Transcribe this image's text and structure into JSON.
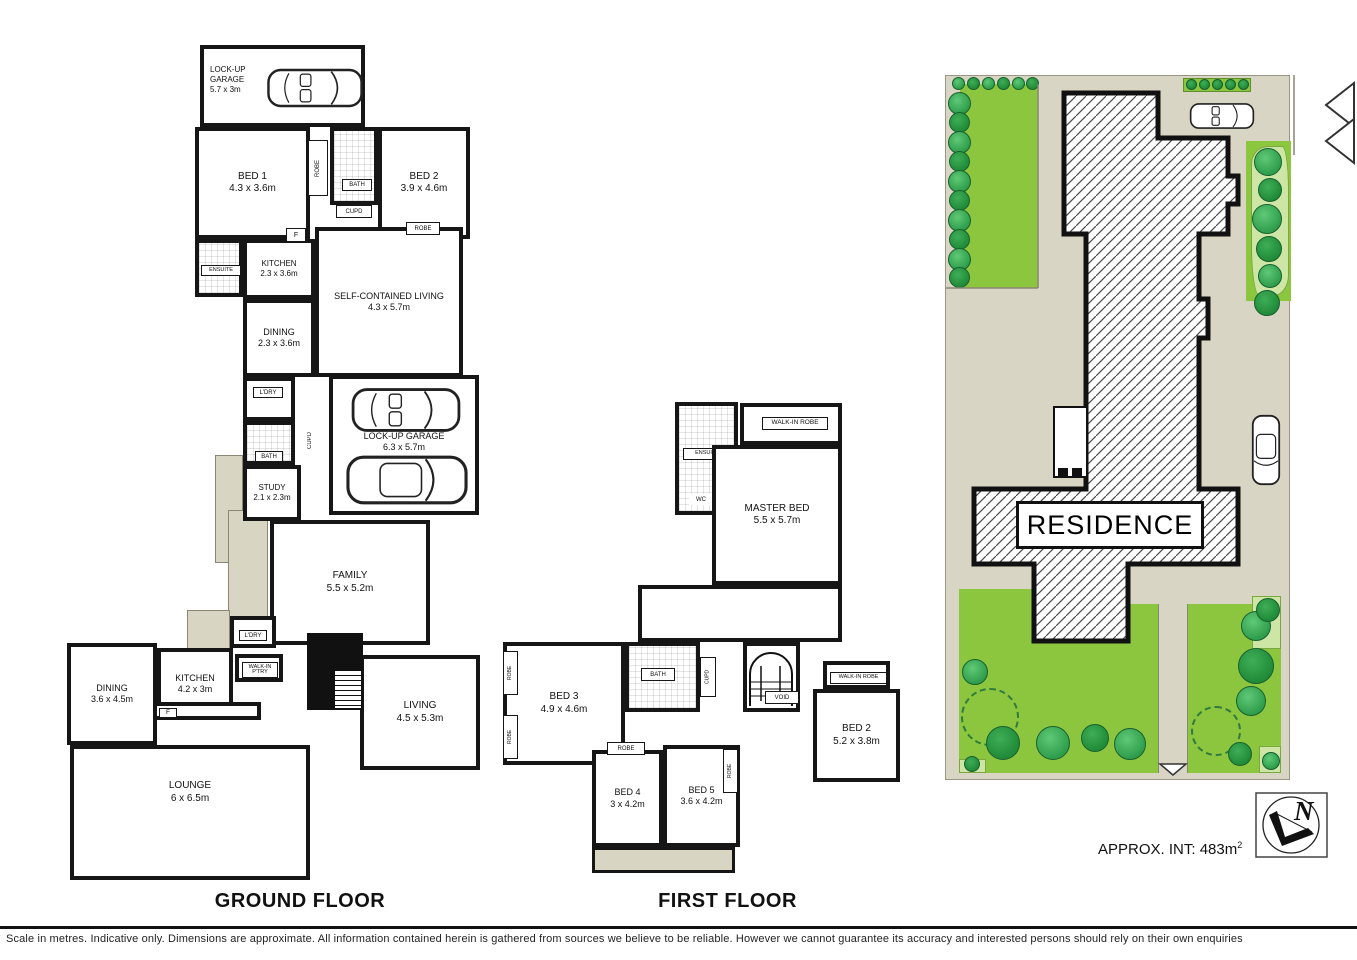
{
  "ground": {
    "title": "GROUND FLOOR",
    "rooms": {
      "garage_top": {
        "name": "LOCK-UP GARAGE",
        "dims": "5.7 x 3m"
      },
      "bed1": {
        "name": "BED 1",
        "dims": "4.3 x 3.6m"
      },
      "bed2": {
        "name": "BED 2",
        "dims": "3.9 x 4.6m"
      },
      "bath_top": {
        "name": "BATH"
      },
      "robe_bed1": {
        "name": "ROBE"
      },
      "robe_bed2": {
        "name": "ROBE"
      },
      "cupd_top": {
        "name": "CUPD"
      },
      "ensuite": {
        "name": "ENSUITE"
      },
      "kitchen_sc": {
        "name": "KITCHEN",
        "dims": "2.3 x 3.6m"
      },
      "fridge_sc": {
        "name": "F"
      },
      "living_sc": {
        "name": "SELF-CONTAINED LIVING",
        "dims": "4.3 x 5.7m"
      },
      "dining_sc": {
        "name": "DINING",
        "dims": "2.3 x 3.6m"
      },
      "ldry_mid": {
        "name": "L'DRY"
      },
      "bath_mid": {
        "name": "BATH"
      },
      "study": {
        "name": "STUDY",
        "dims": "2.1 x 2.3m"
      },
      "cupd_mid": {
        "name": "CUPD"
      },
      "garage_main": {
        "name": "LOCK-UP GARAGE",
        "dims": "6.3 x 5.7m"
      },
      "family": {
        "name": "FAMILY",
        "dims": "5.5 x 5.2m"
      },
      "ldry_low": {
        "name": "L'DRY"
      },
      "pantry": {
        "name": "WALK-IN P'TRY"
      },
      "kitchen_main": {
        "name": "KITCHEN",
        "dims": "4.2 x 3m"
      },
      "fridge_main": {
        "name": "F"
      },
      "dining_main": {
        "name": "DINING",
        "dims": "3.6 x 4.5m"
      },
      "living_main": {
        "name": "LIVING",
        "dims": "4.5 x 5.3m"
      },
      "lounge": {
        "name": "LOUNGE",
        "dims": "6 x 6.5m"
      }
    }
  },
  "first": {
    "title": "FIRST FLOOR",
    "rooms": {
      "ensuite": {
        "name": "ENSUITE"
      },
      "wc": {
        "name": "WC"
      },
      "wir_top": {
        "name": "WALK-IN ROBE"
      },
      "master": {
        "name": "MASTER BED",
        "dims": "5.5 x 5.7m"
      },
      "bed3": {
        "name": "BED 3",
        "dims": "4.9 x 4.6m"
      },
      "robe_b3a": {
        "name": "ROBE"
      },
      "robe_b3b": {
        "name": "ROBE"
      },
      "bath": {
        "name": "BATH"
      },
      "cupd": {
        "name": "CUPD"
      },
      "void": {
        "name": "VOID"
      },
      "wir_right": {
        "name": "WALK-IN ROBE"
      },
      "bed2": {
        "name": "BED 2",
        "dims": "5.2 x 3.8m"
      },
      "bed4": {
        "name": "BED 4",
        "dims": "3 x 4.2m"
      },
      "bed5": {
        "name": "BED 5",
        "dims": "3.6 x 4.2m"
      },
      "robe_b45": {
        "name": "ROBE"
      },
      "robe_b5": {
        "name": "ROBE"
      }
    }
  },
  "site": {
    "residence": "RESIDENCE"
  },
  "compass": {
    "north": "N"
  },
  "footer": {
    "approx_label": "APPROX. INT:",
    "approx_value": "483m",
    "approx_sup": "2",
    "disclaimer": "Scale in metres. Indicative only. Dimensions are approximate. All information contained herein is gathered from sources we believe to be reliable. However we cannot guarantee its accuracy and interested persons should rely on their own enquiries"
  },
  "colors": {
    "wall": "#161616",
    "deck": "#d9d5c3",
    "lawn": "#8cc63f",
    "tree": "#2f9e4c",
    "garden_bed": "#cde6a5"
  }
}
